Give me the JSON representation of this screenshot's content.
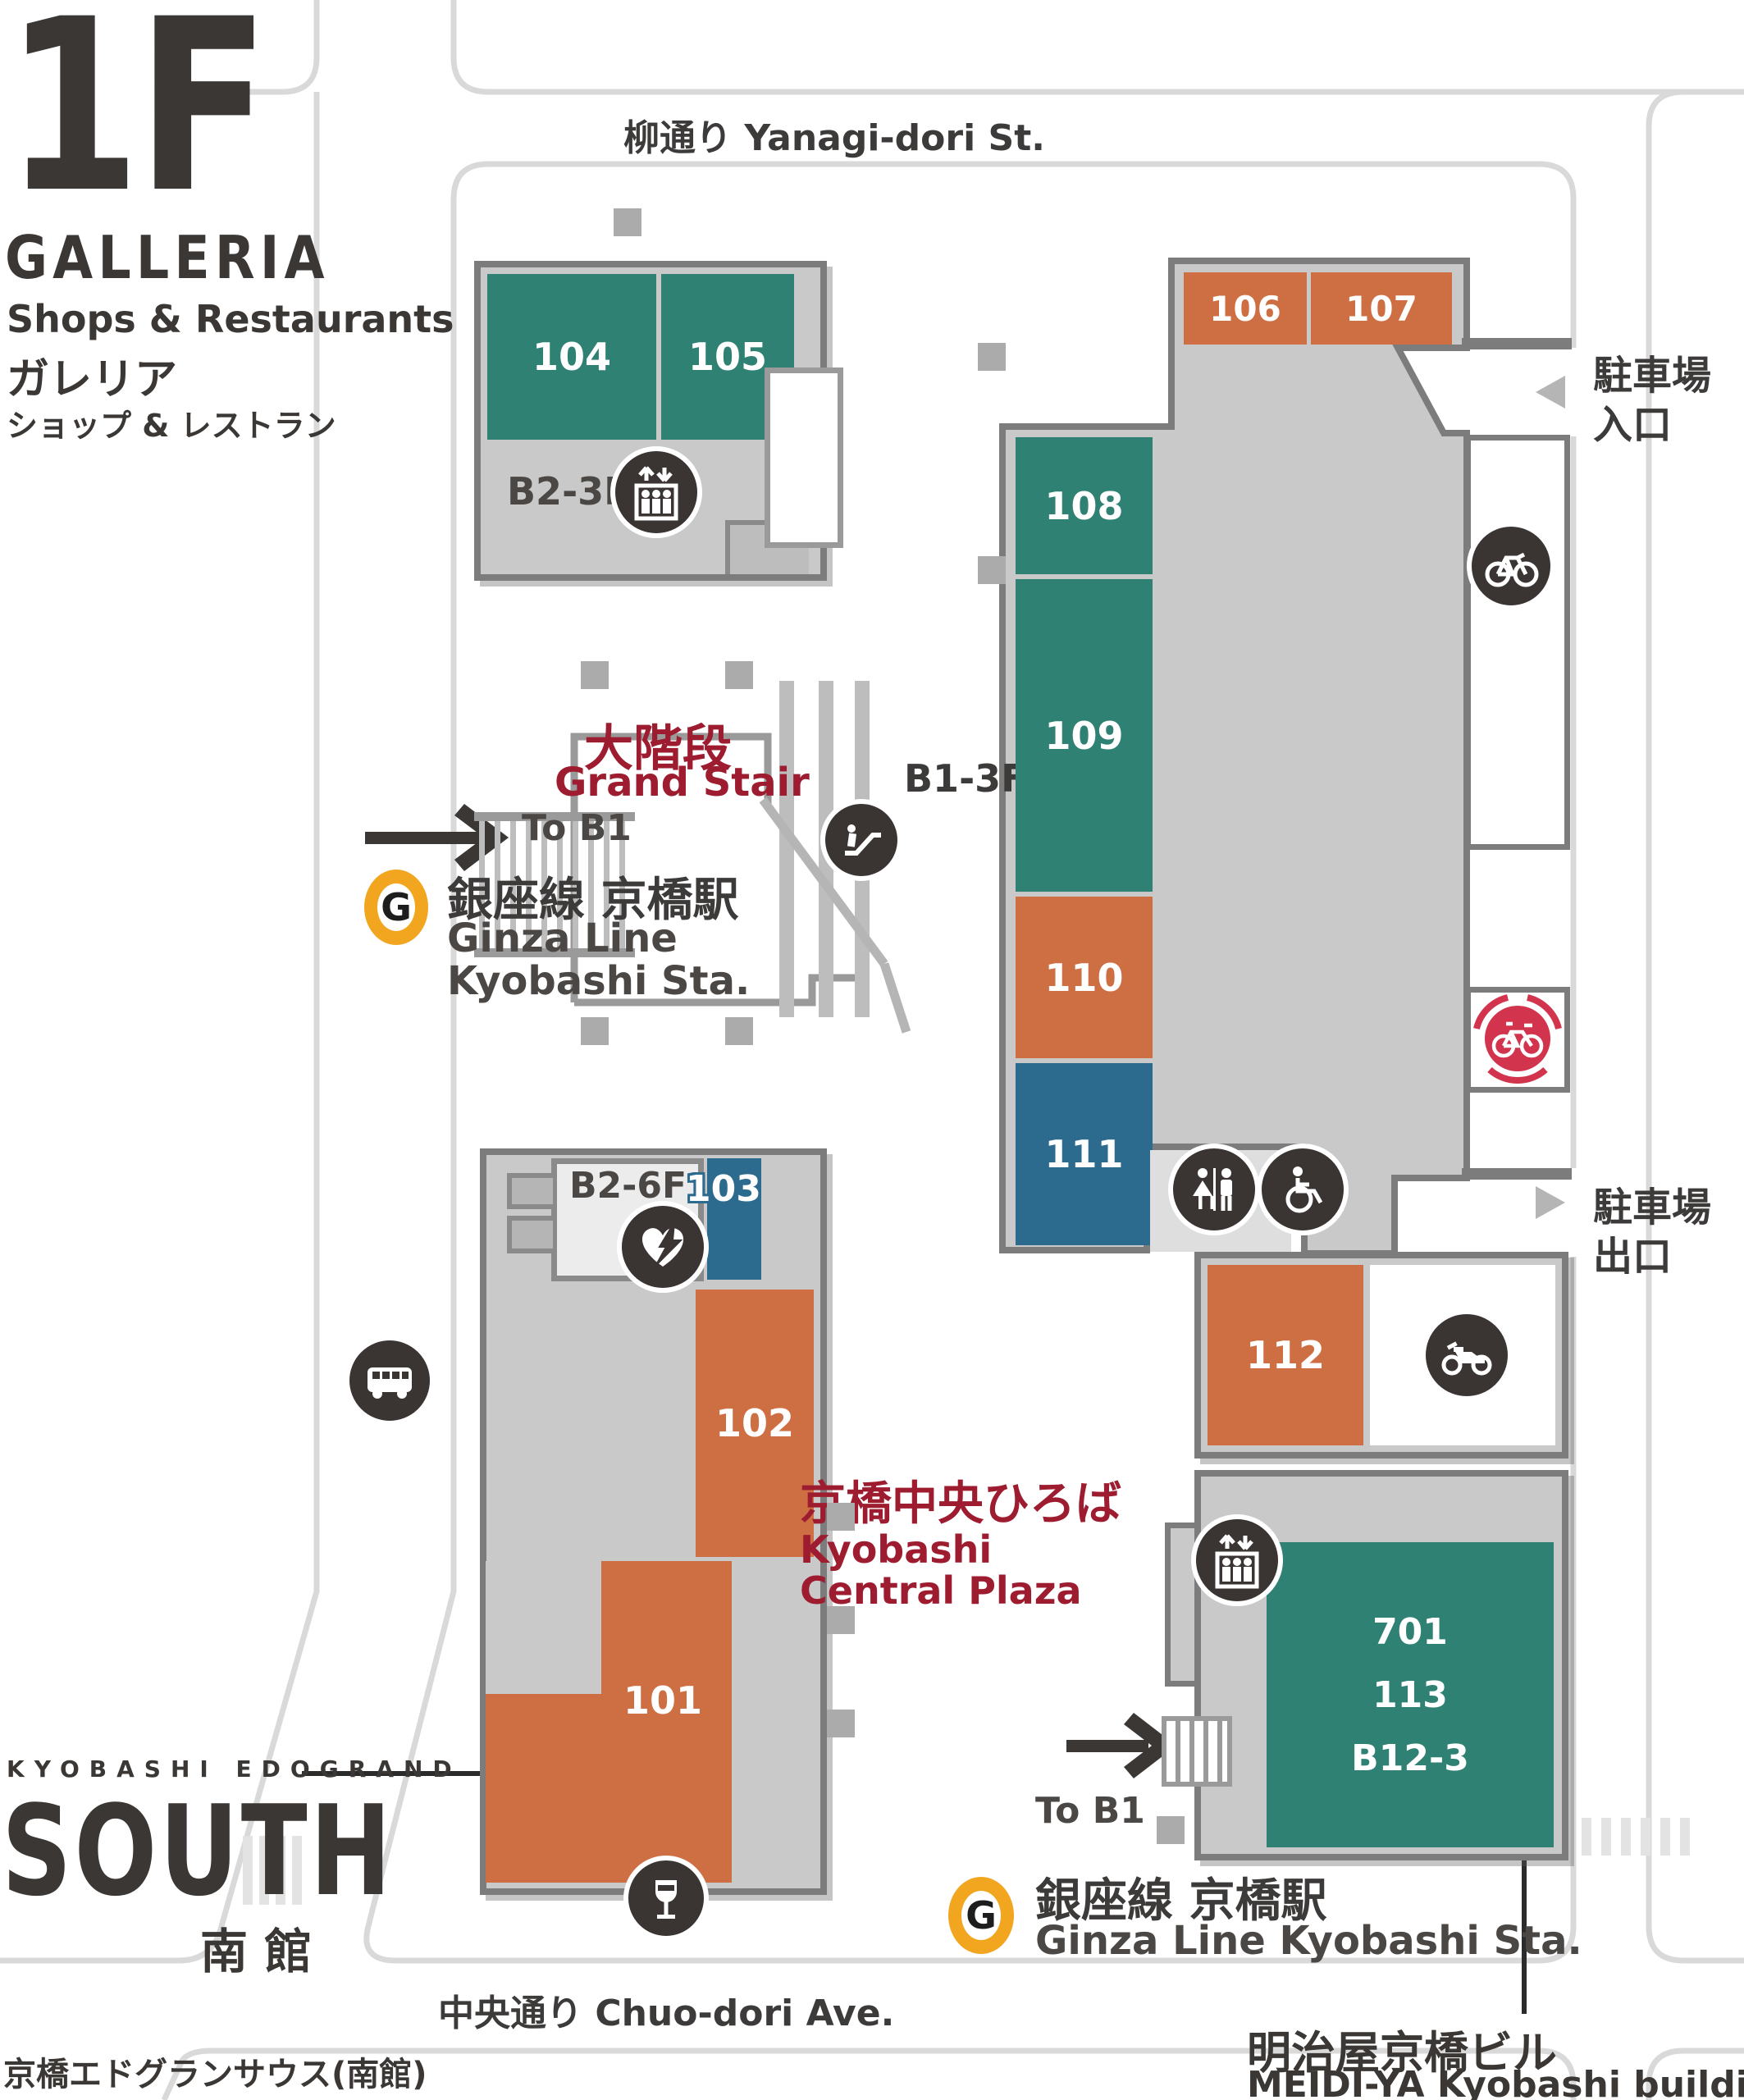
{
  "header": {
    "floor": "1F",
    "building": "GALLERIA",
    "subtitle_en": "Shops & Restaurants",
    "subtitle_jp": "ガレリア",
    "subtitle_jp2": "ショップ & レストラン"
  },
  "streets": {
    "yanagi": "柳通り  Yanagi-dori St.",
    "chuo": "中央通り  Chuo-dori Ave."
  },
  "south_building": {
    "brand": "KYOBASHI EDOGRAND",
    "name": "SOUTH",
    "name_jp": "南 館",
    "full_jp": "京橋エドグランサウス(南館)"
  },
  "meidiya": {
    "jp": "明治屋京橋ビル",
    "en": "MEIDI-YA Kyobashi building"
  },
  "plaza": {
    "jp": "京橋中央ひろば",
    "en1": "Kyobashi",
    "en2": "Central Plaza"
  },
  "grand_stair": {
    "jp": "大階段",
    "en": "Grand Stair",
    "to_b1": "To B1",
    "floors": "B1-3F"
  },
  "station_top": {
    "logo": "G",
    "jp": "銀座線 京橋駅",
    "en1": "Ginza Line",
    "en2": "Kyobashi Sta."
  },
  "station_bottom": {
    "logo": "G",
    "to_b1": "To B1",
    "jp": "銀座線 京橋駅",
    "en": "Ginza Line Kyobashi Sta."
  },
  "parking": {
    "entrance_l1": "駐車場",
    "entrance_l2": "入口",
    "exit_l1": "駐車場",
    "exit_l2": "出口"
  },
  "elevators": {
    "north_floors": "B2-3F",
    "south_floors": "B2-6F"
  },
  "rooms": {
    "r101": "101",
    "r102": "102",
    "r103": "103",
    "r104": "104",
    "r105": "105",
    "r106": "106",
    "r107": "107",
    "r108": "108",
    "r109": "109",
    "r110": "110",
    "r111": "111",
    "r112": "112",
    "r113": "113",
    "r701": "701",
    "b123": "B12-3"
  },
  "icons": [
    "elevator-icon",
    "escalator-icon",
    "stairs",
    "bus-icon",
    "wine-bar-icon",
    "bicycle-parking-icon",
    "bike-share-icon",
    "restroom-icon",
    "wheelchair-icon",
    "motorcycle-parking-icon",
    "aed-icon",
    "ginza-line-logo"
  ],
  "colors": {
    "teal": "#2F8173",
    "orange": "#CE6F43",
    "blue": "#2C6A8E",
    "red_text": "#9E1C30",
    "ginza": "#F2A51F",
    "icon": "#3A3433",
    "red_icon": "#D2344E",
    "street_line": "#D9D9D9",
    "building_fill": "#C9C9C9",
    "building_border": "#7C7C7C"
  }
}
